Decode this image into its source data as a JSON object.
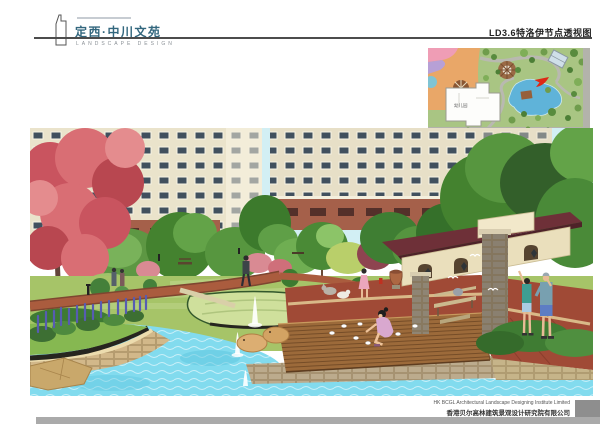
{
  "header": {
    "brand_title": "定西·中川文苑",
    "brand_subtitle": "LANDSCAPE DESIGN",
    "sheet_title": "LD3.6特洛伊节点透视图"
  },
  "inset_map": {
    "building_label": "幼儿园",
    "viewpoint_marker_color": "#dd2816"
  },
  "footer": {
    "company_en": "HK BCGL Architectural Landscape Designing Institute Limited",
    "company_cn": "香港贝尔高林建筑景观设计研究院有限公司"
  },
  "colors": {
    "brand_teal": "#33677e",
    "rule_gray": "#4c4c4c",
    "bottom_bar_gray": "#aaaaaa",
    "corner_block_gray": "#8e8e8e",
    "sky": "#d2eff4",
    "water": "#82dbee",
    "lawn": "#a6c468",
    "deck_wood": "#9c6a3a",
    "paving_red": "#a04a36",
    "canopy_maroon": "#6e3038",
    "blossom_pink": "#c9545f",
    "lupine_purple": "#575cb2"
  }
}
